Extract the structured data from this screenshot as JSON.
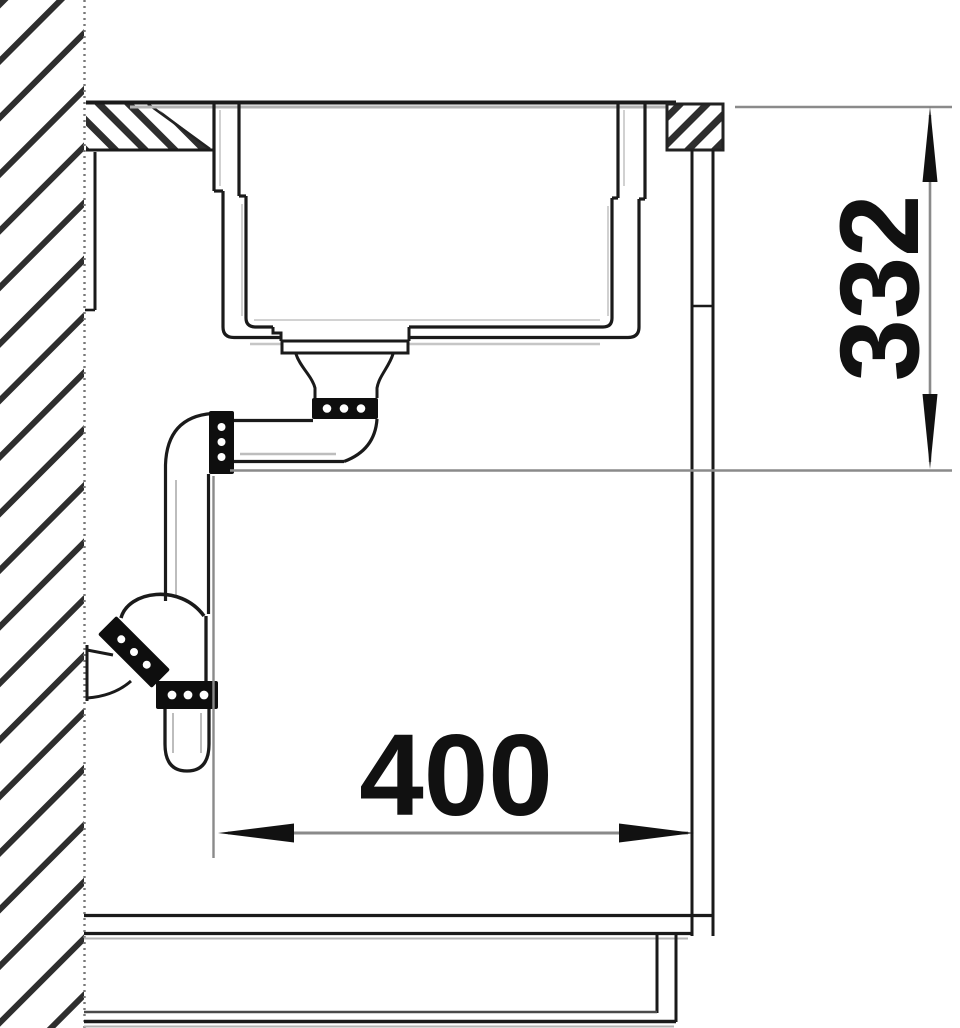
{
  "drawing": {
    "type": "sink-installation-cross-section",
    "dimension_horizontal": {
      "label": "400",
      "orientation": "horizontal"
    },
    "dimension_vertical": {
      "label": "332",
      "orientation": "vertical-rotated"
    },
    "colors": {
      "line": "#1a1a1a",
      "nut_fill": "#0e0e0e",
      "construction_line": "#8a8a8a",
      "shadow_line": "#b3b3b3",
      "background": "#ffffff"
    },
    "parts": [
      "wall-section-hatched",
      "countertop",
      "sink-basin",
      "drain-strainer",
      "drain-coupling-nut",
      "drain-pipe-elbow",
      "siphon-trap",
      "wall-outlet",
      "cabinet-side-panel",
      "cabinet-bottom",
      "plinth"
    ]
  }
}
